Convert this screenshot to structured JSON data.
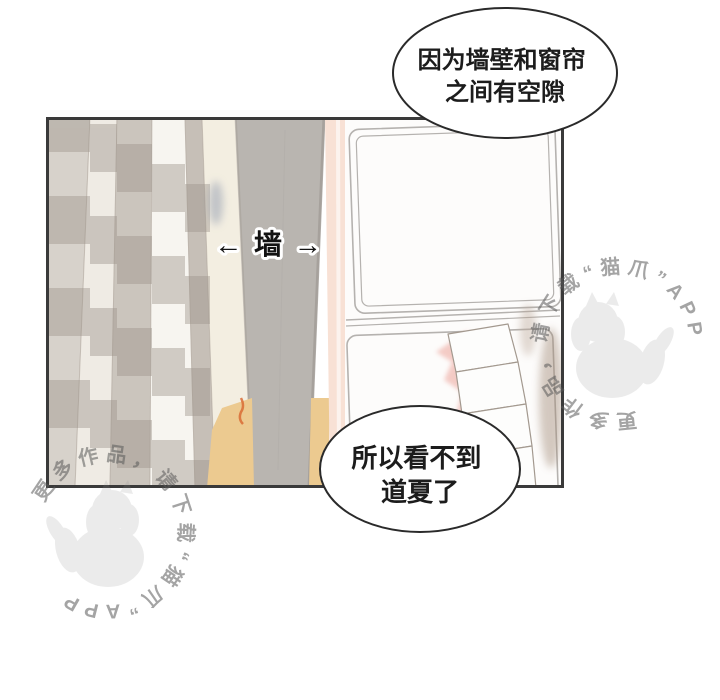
{
  "panel": {
    "wall_label": "← 墙 →"
  },
  "speech_bubbles": {
    "top": {
      "line1": "因为墙壁和窗帘",
      "line2": "之间有空隙"
    },
    "bottom": {
      "line1": "所以看不到",
      "line2": "道夏了"
    }
  },
  "watermarks": {
    "text": "更多作品，请下载“猫爪”APP",
    "app_name": "猫爪"
  },
  "colors": {
    "panel_border": "#3a3a3a",
    "wall_gray": "#b9b5b0",
    "peach_wall": "#f8e1d5",
    "floor_wood": "#ecca90",
    "curtain_light": "#efebe4",
    "curtain_gray": "#cbc5bd",
    "curtain_cream_edge": "#f3eee1",
    "curtain_band": "#9c938a",
    "quilt_shadow_pink": "#f3c6c0",
    "quilt_shadow_brown": "#a18a77",
    "bubble_outline": "#2a2a2a",
    "watermark_text": "#5a5a5a"
  }
}
